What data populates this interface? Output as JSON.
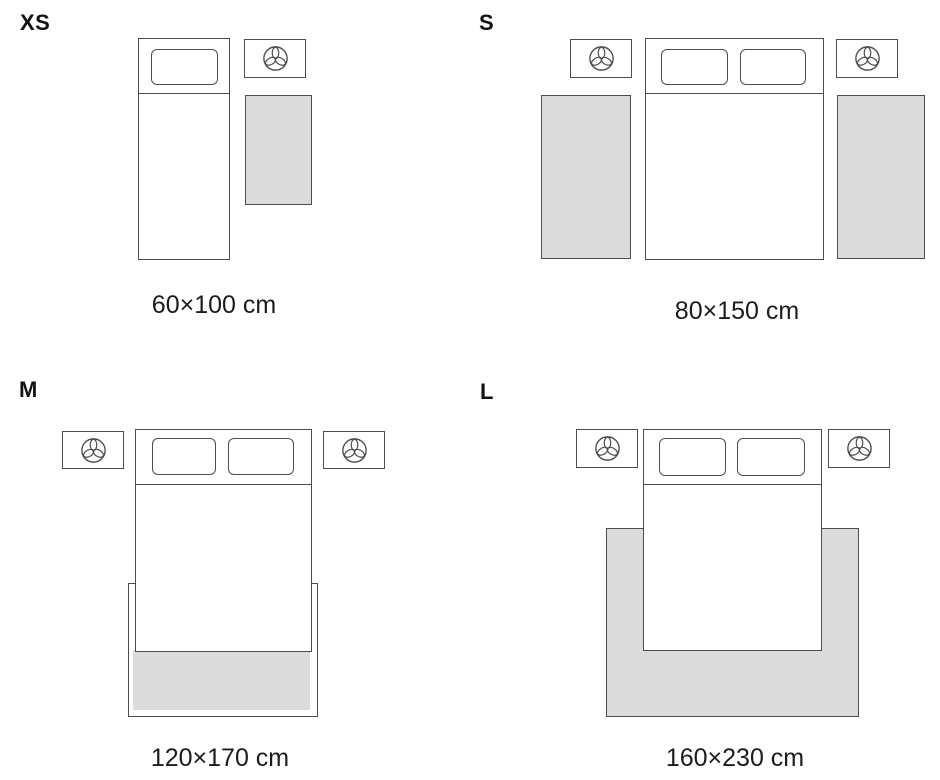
{
  "colors": {
    "background": "#ffffff",
    "outline": "#4d4d4d",
    "rug_fill": "#dbdbdb",
    "text": "#1c1c1c"
  },
  "icons": {
    "nightstand_symbol": "lamp-icon"
  },
  "sizes": [
    {
      "id": "xs",
      "label": "XS",
      "caption": "60×100 cm",
      "bed": "single",
      "rug_count": 1,
      "rug_placement": "beside-bed"
    },
    {
      "id": "s",
      "label": "S",
      "caption": "80×150 cm",
      "bed": "double",
      "rug_count": 2,
      "rug_placement": "both-sides-of-bed"
    },
    {
      "id": "m",
      "label": "M",
      "caption": "120×170 cm",
      "bed": "double",
      "rug_count": 1,
      "rug_placement": "under-foot-of-bed"
    },
    {
      "id": "l",
      "label": "L",
      "caption": "160×230 cm",
      "bed": "double",
      "rug_count": 1,
      "rug_placement": "under-bed"
    }
  ]
}
